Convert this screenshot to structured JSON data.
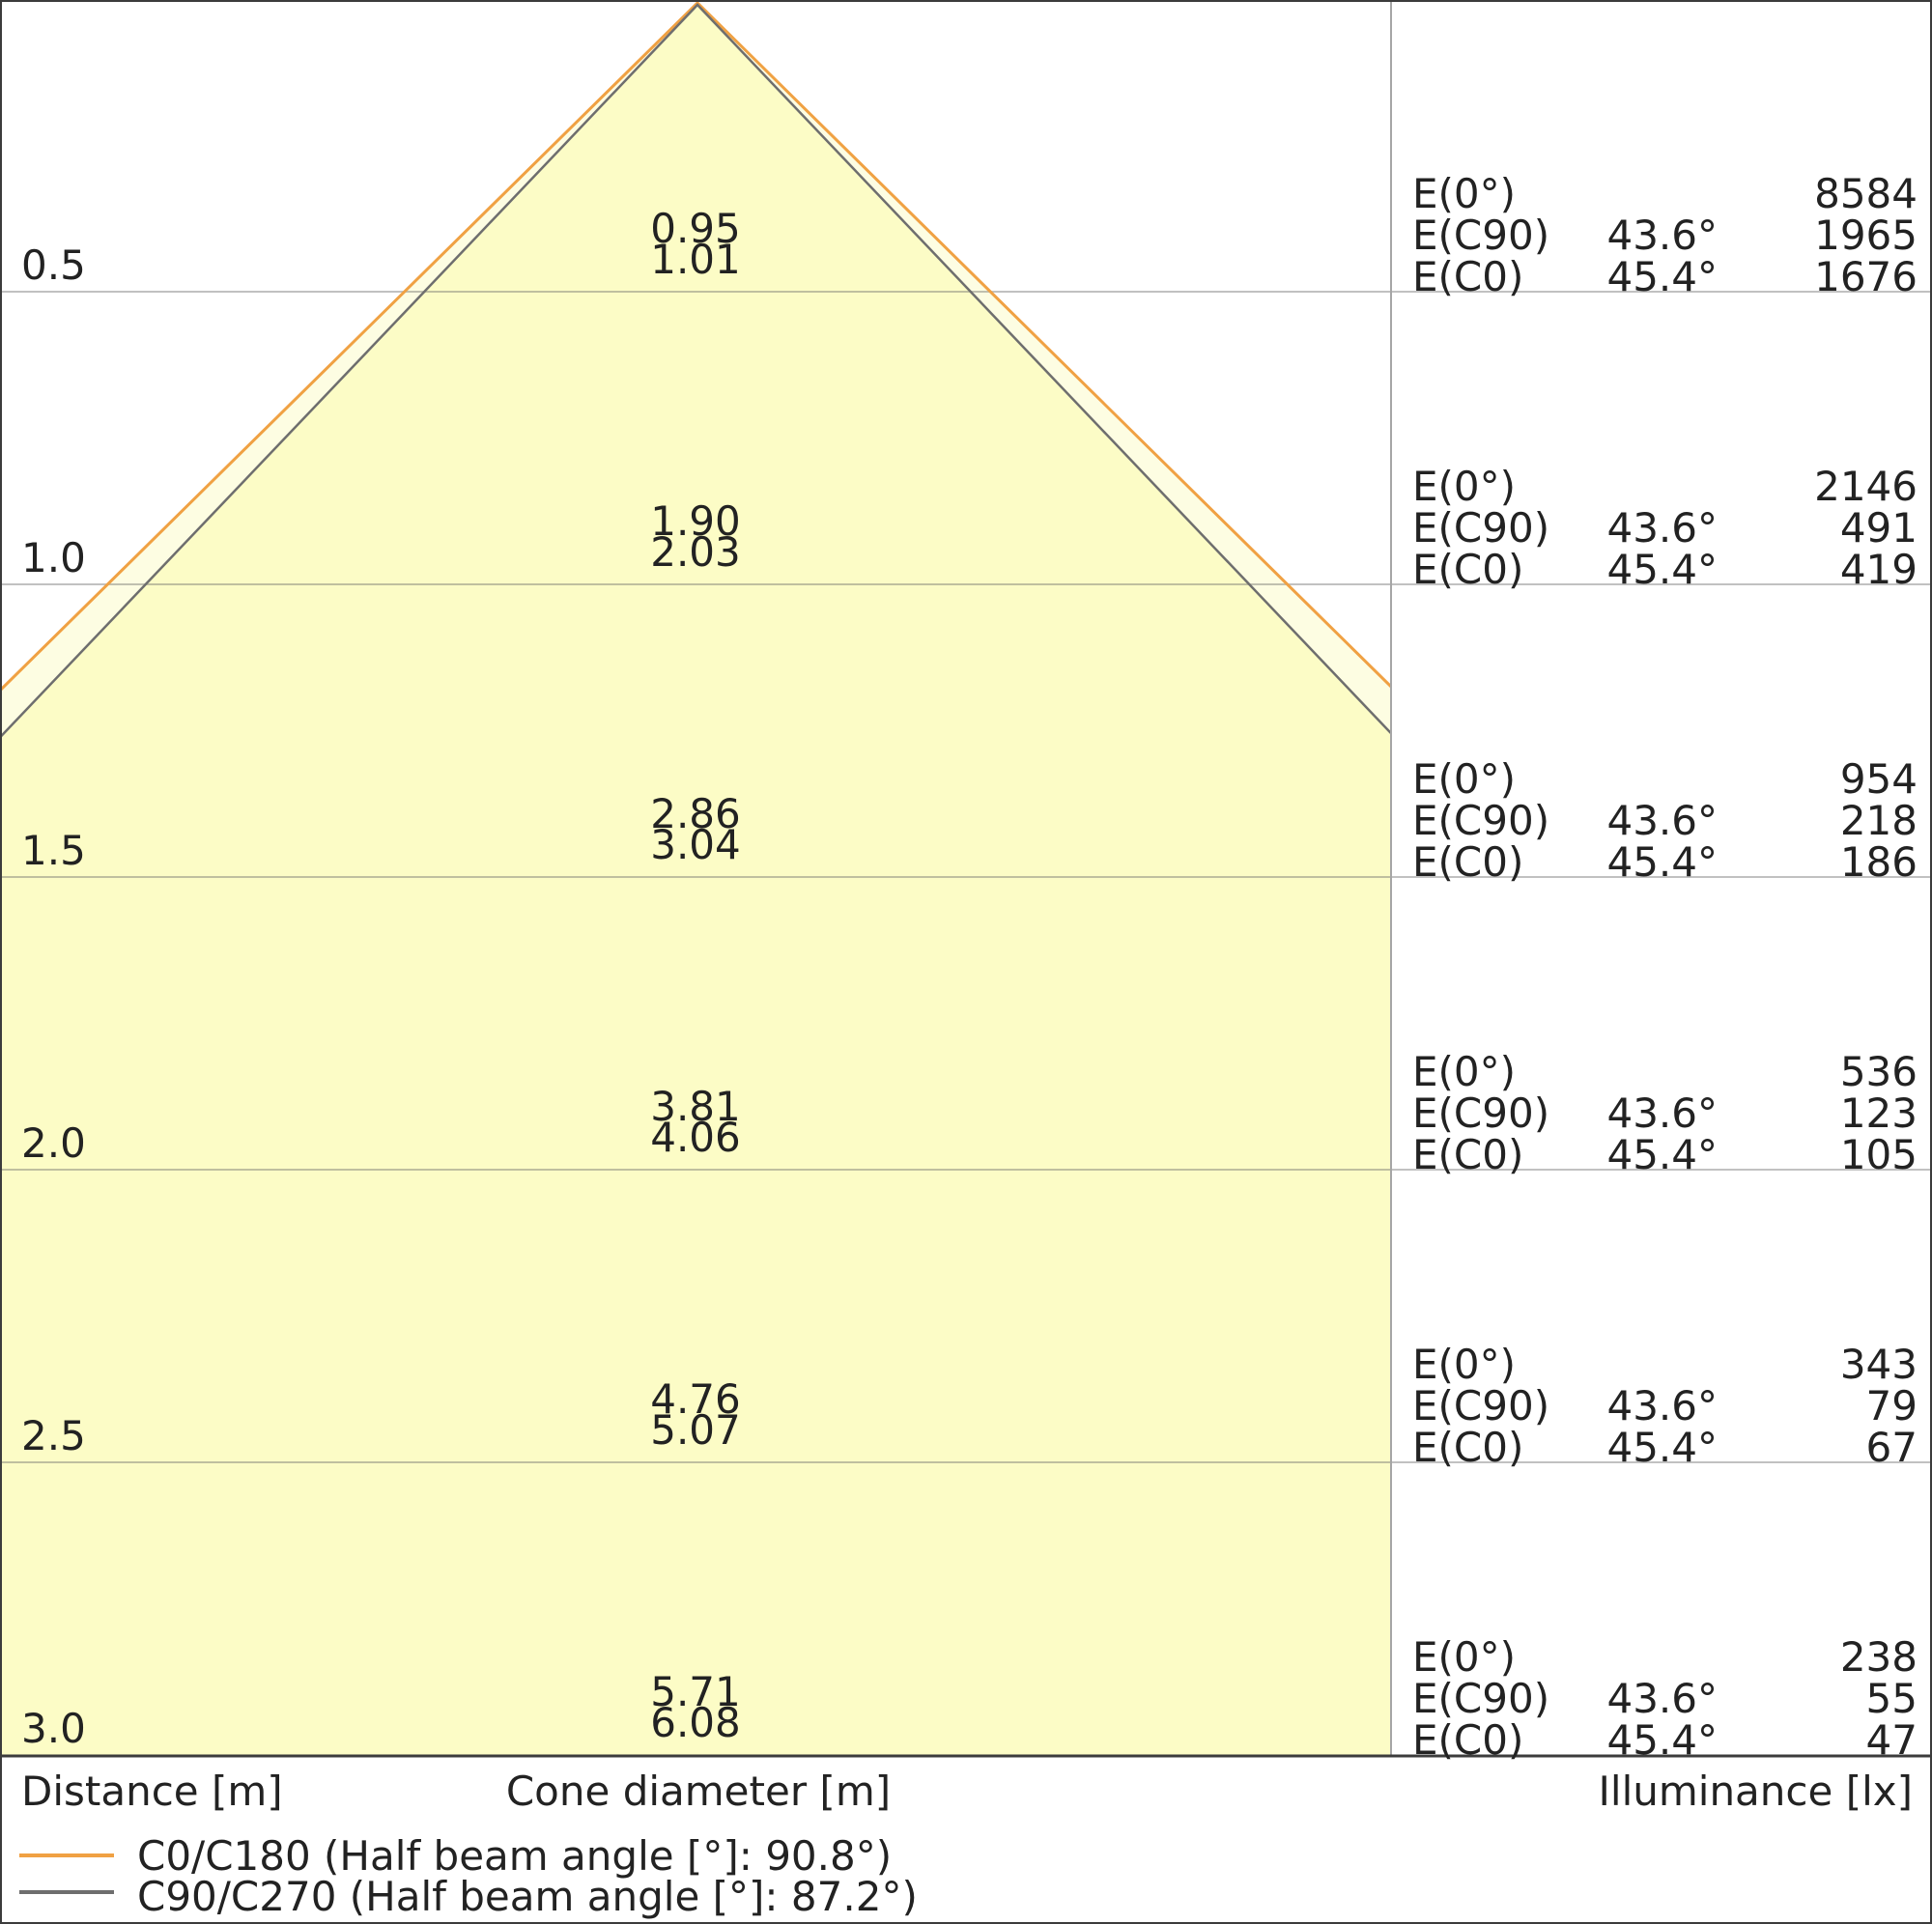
{
  "colors": {
    "c0_line": "#f0a143",
    "c90_line": "#6e6e6e",
    "fill_outer": "#fdfde2",
    "fill_inner": "#fcfcc6",
    "border": "#3c3c3c",
    "text": "#222222"
  },
  "axis": {
    "distance_label": "Distance [m]",
    "cone_diameter_label": "Cone diameter [m]",
    "illuminance_label": "Illuminance [lx]"
  },
  "panel": {
    "e0_label": "E(0°)",
    "ec90_label": "E(C90)",
    "ec0_label": "E(C0)"
  },
  "legend": {
    "c0": {
      "label": "C0/C180 (Half beam angle [°]: 90.8°)"
    },
    "c90": {
      "label": "C90/C270 (Half beam angle [°]: 87.2°)"
    }
  },
  "rows": [
    {
      "distance": "0.5",
      "d_c90": "0.95",
      "d_c0": "1.01",
      "e0": "8584",
      "a90": "43.6°",
      "e90": "1965",
      "a0": "45.4°",
      "ec0": "1676"
    },
    {
      "distance": "1.0",
      "d_c90": "1.90",
      "d_c0": "2.03",
      "e0": "2146",
      "a90": "43.6°",
      "e90": "491",
      "a0": "45.4°",
      "ec0": "419"
    },
    {
      "distance": "1.5",
      "d_c90": "2.86",
      "d_c0": "3.04",
      "e0": "954",
      "a90": "43.6°",
      "e90": "218",
      "a0": "45.4°",
      "ec0": "186"
    },
    {
      "distance": "2.0",
      "d_c90": "3.81",
      "d_c0": "4.06",
      "e0": "536",
      "a90": "43.6°",
      "e90": "123",
      "a0": "45.4°",
      "ec0": "105"
    },
    {
      "distance": "2.5",
      "d_c90": "4.76",
      "d_c0": "5.07",
      "e0": "343",
      "a90": "43.6°",
      "e90": "79",
      "a0": "45.4°",
      "ec0": "67"
    },
    {
      "distance": "3.0",
      "d_c90": "5.71",
      "d_c0": "6.08",
      "e0": "238",
      "a90": "43.6°",
      "e90": "55",
      "a0": "45.4°",
      "ec0": "47"
    }
  ],
  "chart_data": {
    "type": "area",
    "subtype": "light-cone-diagram",
    "ylabel": "Distance [m]",
    "xlabel": "Cone diameter [m]",
    "value_label": "Illuminance [lx]",
    "distances_m": [
      0.5,
      1.0,
      1.5,
      2.0,
      2.5,
      3.0
    ],
    "series": [
      {
        "name": "C0/C180",
        "half_beam_angle_deg": 90.8,
        "half_angle_label": "45.4°",
        "cone_diameter_m": [
          1.01,
          2.03,
          3.04,
          4.06,
          5.07,
          6.08
        ],
        "illuminance_lx": [
          1676,
          419,
          186,
          105,
          67,
          47
        ],
        "color": "#f0a143"
      },
      {
        "name": "C90/C270",
        "half_beam_angle_deg": 87.2,
        "half_angle_label": "43.6°",
        "cone_diameter_m": [
          0.95,
          1.9,
          2.86,
          3.81,
          4.76,
          5.71
        ],
        "illuminance_lx": [
          1965,
          491,
          218,
          123,
          79,
          55
        ],
        "color": "#6e6e6e"
      }
    ],
    "e0_lx": [
      8584,
      2146,
      954,
      536,
      343,
      238
    ],
    "grid": true,
    "legend_position": "bottom-left"
  }
}
